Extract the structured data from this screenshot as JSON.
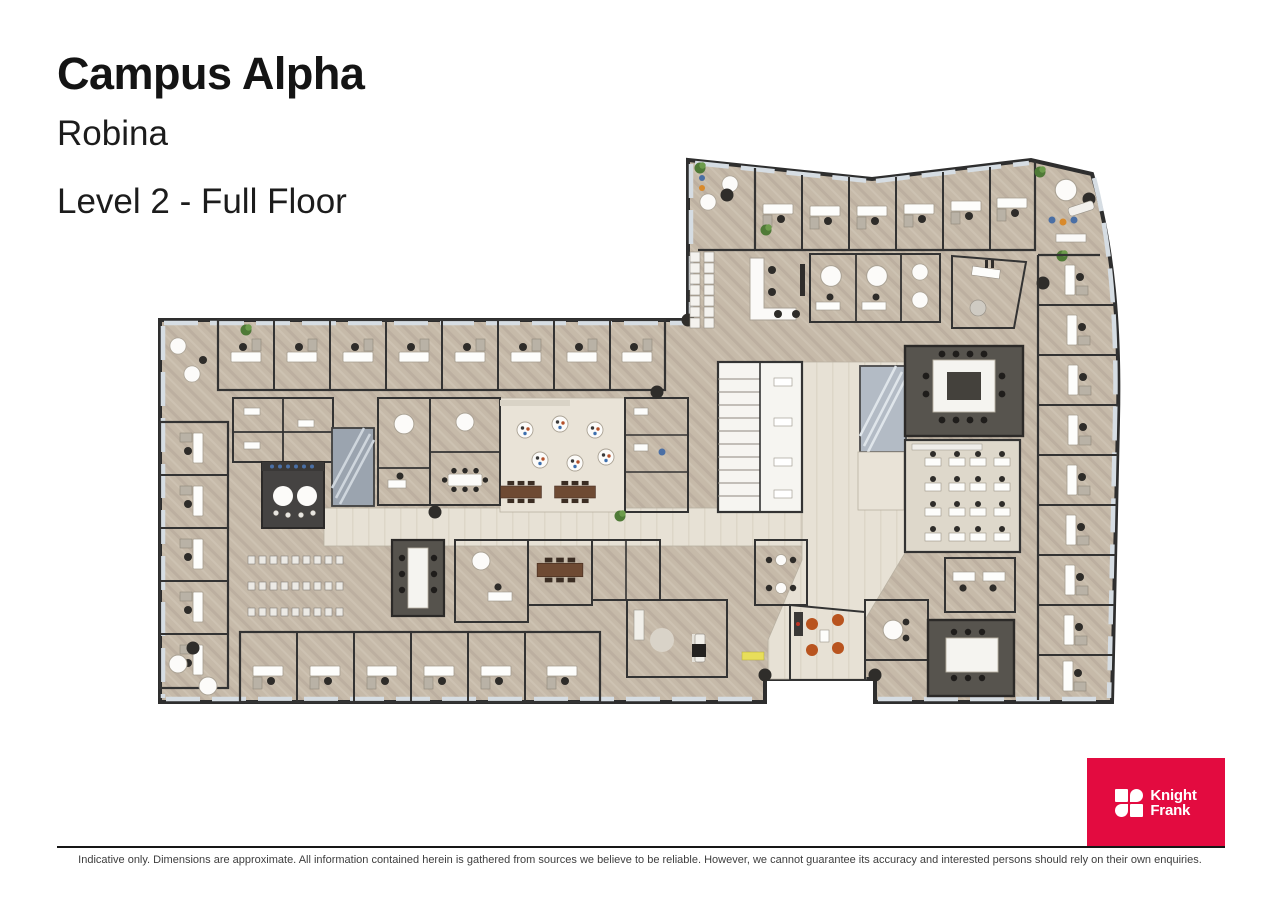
{
  "header": {
    "title": "Campus Alpha",
    "subtitle": "Robina",
    "level": "Level 2 - Full Floor"
  },
  "brand": {
    "name_line1": "Knight",
    "name_line2": "Frank",
    "logo_background": "#e30b40",
    "logo_text_color": "#ffffff"
  },
  "footer": {
    "disclaimer": "Indicative only. Dimensions are approximate. All information contained herein is gathered from sources we believe to be reliable. However, we cannot guarantee its accuracy and interested persons should rely on their own enquiries."
  },
  "floor_plan": {
    "label": "Level 2 full floor plan, 3D rendered top-down view",
    "palette": {
      "wall": "#303030",
      "carpet": "#c6baa9",
      "corridor": "#e7e1d5",
      "room_white": "#f8f7f3",
      "dark_room": "#57544e",
      "kitchen_dark": "#454342",
      "timber_table": "#6e4a33",
      "stair_grey": "#a3abb5",
      "window_glass": "#d6dde3",
      "plant_green": "#4f7a37",
      "accent_orange_chair": "#b9541f"
    }
  }
}
